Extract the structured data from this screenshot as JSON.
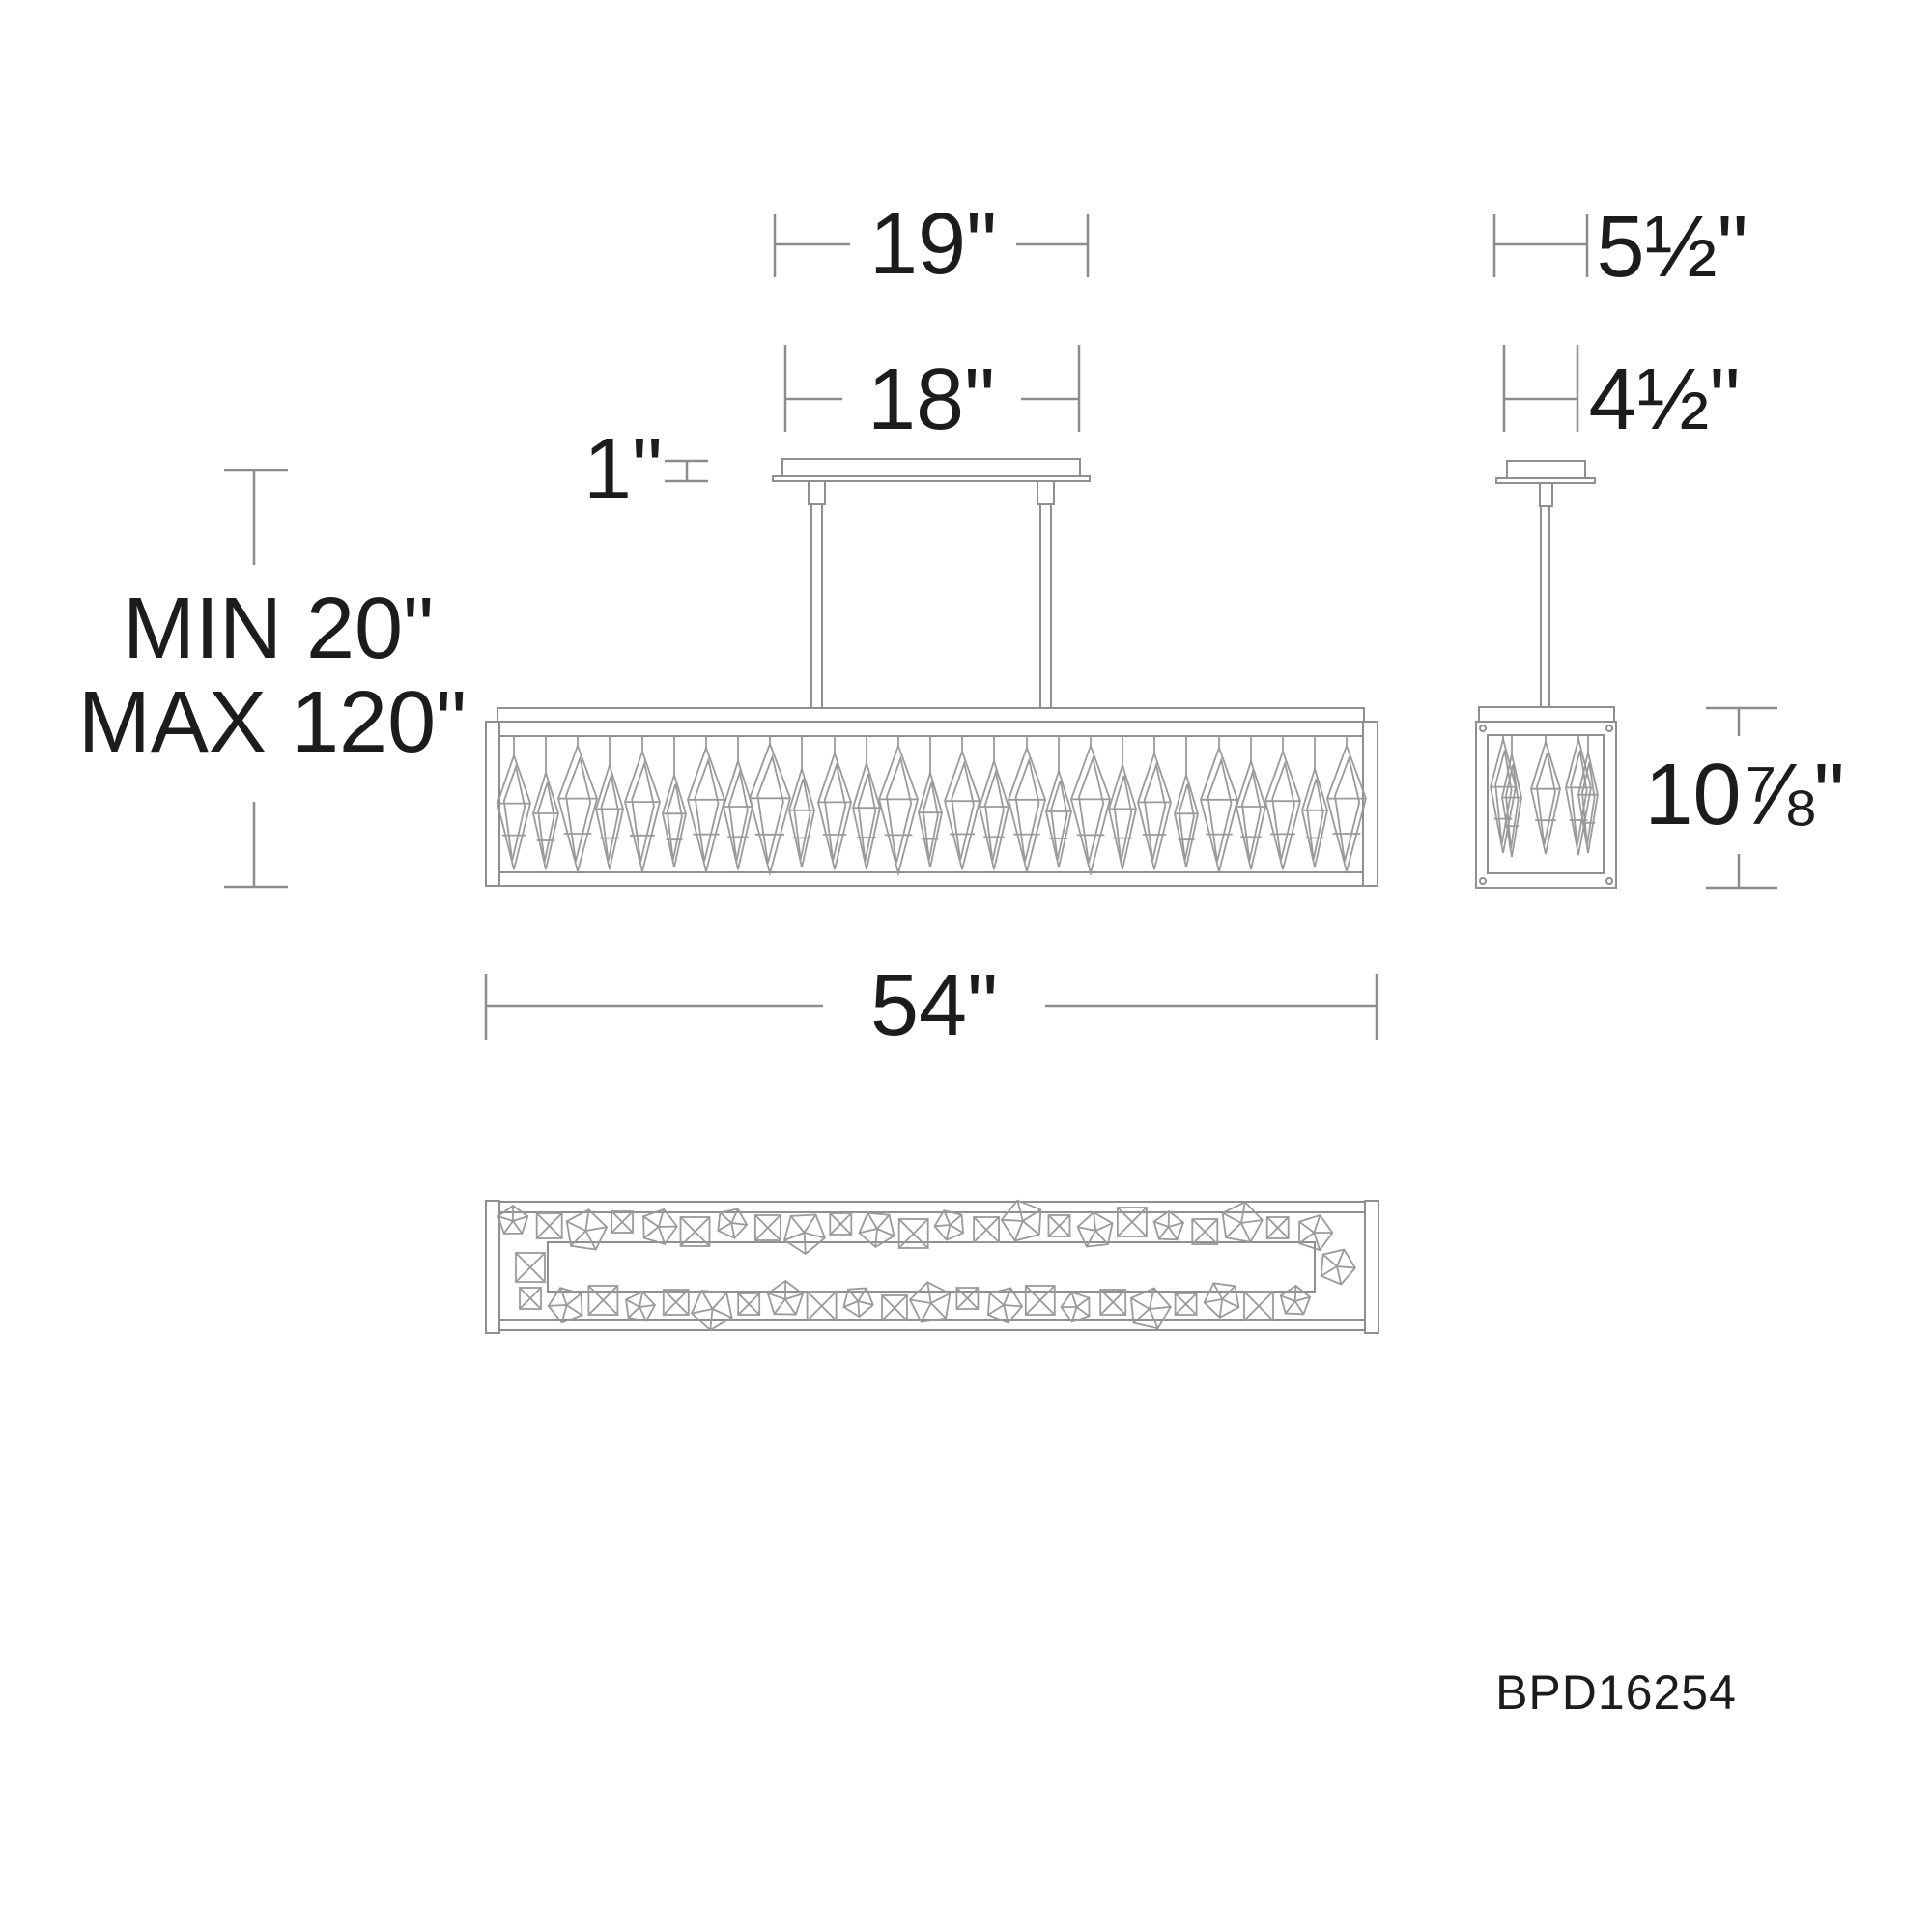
{
  "page": {
    "part_number": "BPD16254"
  },
  "colors": {
    "background": "#ffffff",
    "drawing_line": "#8f8f8f",
    "dimension_line": "#8c8c8c",
    "crystal_line": "#9a9a9a",
    "label_text": "#1c1c1c"
  },
  "labels": {
    "canopy_overall_width": "19\"",
    "canopy_width": "18\"",
    "canopy_height": "1\"",
    "min_suspension": "MIN 20\"",
    "max_suspension": "MAX 120\"",
    "fixture_length": "54\"",
    "side_overall_depth": "5½\"",
    "side_canopy_depth": "4½\"",
    "fixture_height": "10⅞\""
  }
}
